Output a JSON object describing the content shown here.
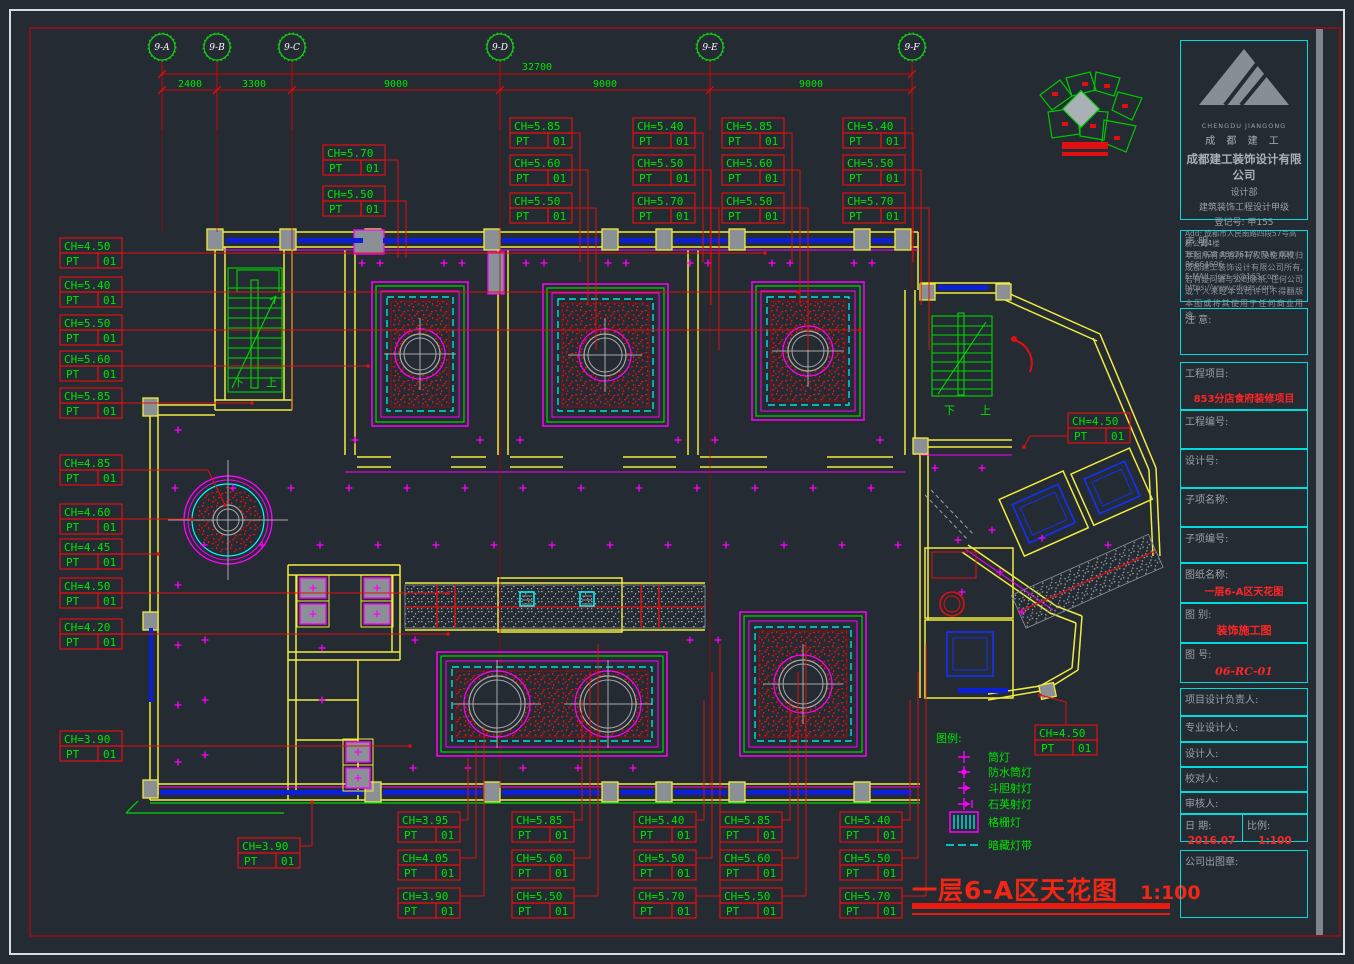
{
  "palette": {
    "bg": "#242B33",
    "red": "#FF2222",
    "green": "#00E400",
    "yellow": "#F0EC3F",
    "magenta": "#FF00FF",
    "cyan": "#00FFFF",
    "blue": "#0A1FD6",
    "gray": "#8A9096"
  },
  "grid": {
    "bubbles": [
      "9-A",
      "9-B",
      "9-C",
      "9-D",
      "9-E",
      "9-F"
    ],
    "overall_dim": "32700",
    "segment_dims": [
      "2400",
      "3300",
      "9000",
      "9000",
      "9000"
    ]
  },
  "stairs": {
    "down_label": "下",
    "up_label": "上"
  },
  "ch_labels": {
    "ch_prefix": "CH=",
    "pt_label": "PT",
    "pt_value": "01",
    "groups": [
      {
        "id": "t1",
        "values": [
          "5.70",
          "5.50"
        ]
      },
      {
        "id": "t2",
        "values": [
          "5.85",
          "5.60",
          "5.50"
        ]
      },
      {
        "id": "t3",
        "values": [
          "5.40",
          "5.50",
          "5.70"
        ]
      },
      {
        "id": "t4",
        "values": [
          "5.85",
          "5.60",
          "5.50"
        ]
      },
      {
        "id": "t5",
        "values": [
          "5.40",
          "5.50",
          "5.70"
        ]
      },
      {
        "id": "left",
        "values": [
          "4.50",
          "5.40",
          "5.50",
          "5.60",
          "5.85",
          "4.85",
          "4.60",
          "4.45",
          "4.50",
          "4.20",
          "3.90"
        ]
      },
      {
        "id": "bls",
        "values": [
          "3.90"
        ]
      },
      {
        "id": "b1",
        "values": [
          "3.95",
          "4.05",
          "3.90"
        ]
      },
      {
        "id": "b2",
        "values": [
          "5.85",
          "5.60",
          "5.50"
        ]
      },
      {
        "id": "b3",
        "values": [
          "5.40",
          "5.50",
          "5.70"
        ]
      },
      {
        "id": "b4",
        "values": [
          "5.85",
          "5.60",
          "5.50"
        ]
      },
      {
        "id": "b5",
        "values": [
          "5.40",
          "5.50",
          "5.70"
        ]
      },
      {
        "id": "ru",
        "values": [
          "4.50"
        ]
      },
      {
        "id": "rl",
        "values": [
          "4.50"
        ]
      }
    ]
  },
  "legend": {
    "title": "图例:",
    "items": [
      {
        "icon": "downlight-icon",
        "label": "筒灯"
      },
      {
        "icon": "waterproof-downlight-icon",
        "label": "防水筒灯"
      },
      {
        "icon": "adjustable-spotlight-icon",
        "label": "斗胆射灯"
      },
      {
        "icon": "quartz-spotlight-icon",
        "label": "石英射灯"
      },
      {
        "icon": "grille-light-icon",
        "label": "格栅灯"
      },
      {
        "icon": "concealed-strip-icon",
        "label": "暗藏灯带"
      }
    ]
  },
  "drawing_title": {
    "text": "一层6-A区天花图",
    "scale": "1:100"
  },
  "title_block": {
    "company": {
      "logo_en": "CHENGDU JIANGONG",
      "logo_cn": "成 都 建 工",
      "name": "成都建工装饰设计有限公司",
      "dept": "设计部",
      "qualification": "建筑装饰工程设计甲级",
      "reg_no": "登记号: 甲155",
      "address": "Add: 成都市人民南路四段57号高新公寓4楼",
      "tel": "TEL: 028 86626177  FAX: 028 86664696",
      "email": "E-MAIL: jgzs-sj@163.com",
      "web": "https://www.cdjgzs.com"
    },
    "statement": {
      "label": "声 明:",
      "body": "本图所有内容所有权及使用权归成都建工装饰设计有限公司所有, 若有疑问请与公司联系, 任何公司或个人未经本公司许可不得翻版本图或将其使用于任何商业用途。"
    },
    "note_label": "注 意:",
    "fields": [
      {
        "label": "工程项目:",
        "value": "853分店食府装修项目"
      },
      {
        "label": "工程编号:",
        "value": ""
      },
      {
        "label": "设计号:",
        "value": ""
      },
      {
        "label": "子项名称:",
        "value": ""
      },
      {
        "label": "子项编号:",
        "value": ""
      },
      {
        "label": "图纸名称:",
        "value": "一层6-A区天花图"
      },
      {
        "label": "图 别:",
        "value": "装饰施工图"
      },
      {
        "label": "图 号:",
        "value": "06-RC-01"
      }
    ],
    "sign_rows": [
      "项目设计负责人:",
      "专业设计人:",
      "设计人:",
      "校对人:",
      "审核人:"
    ],
    "date": {
      "label": "日 期:",
      "value": "2016.07"
    },
    "scale": {
      "label": "比例:",
      "value": "1:100"
    },
    "stamp_label": "公司出图章:"
  }
}
